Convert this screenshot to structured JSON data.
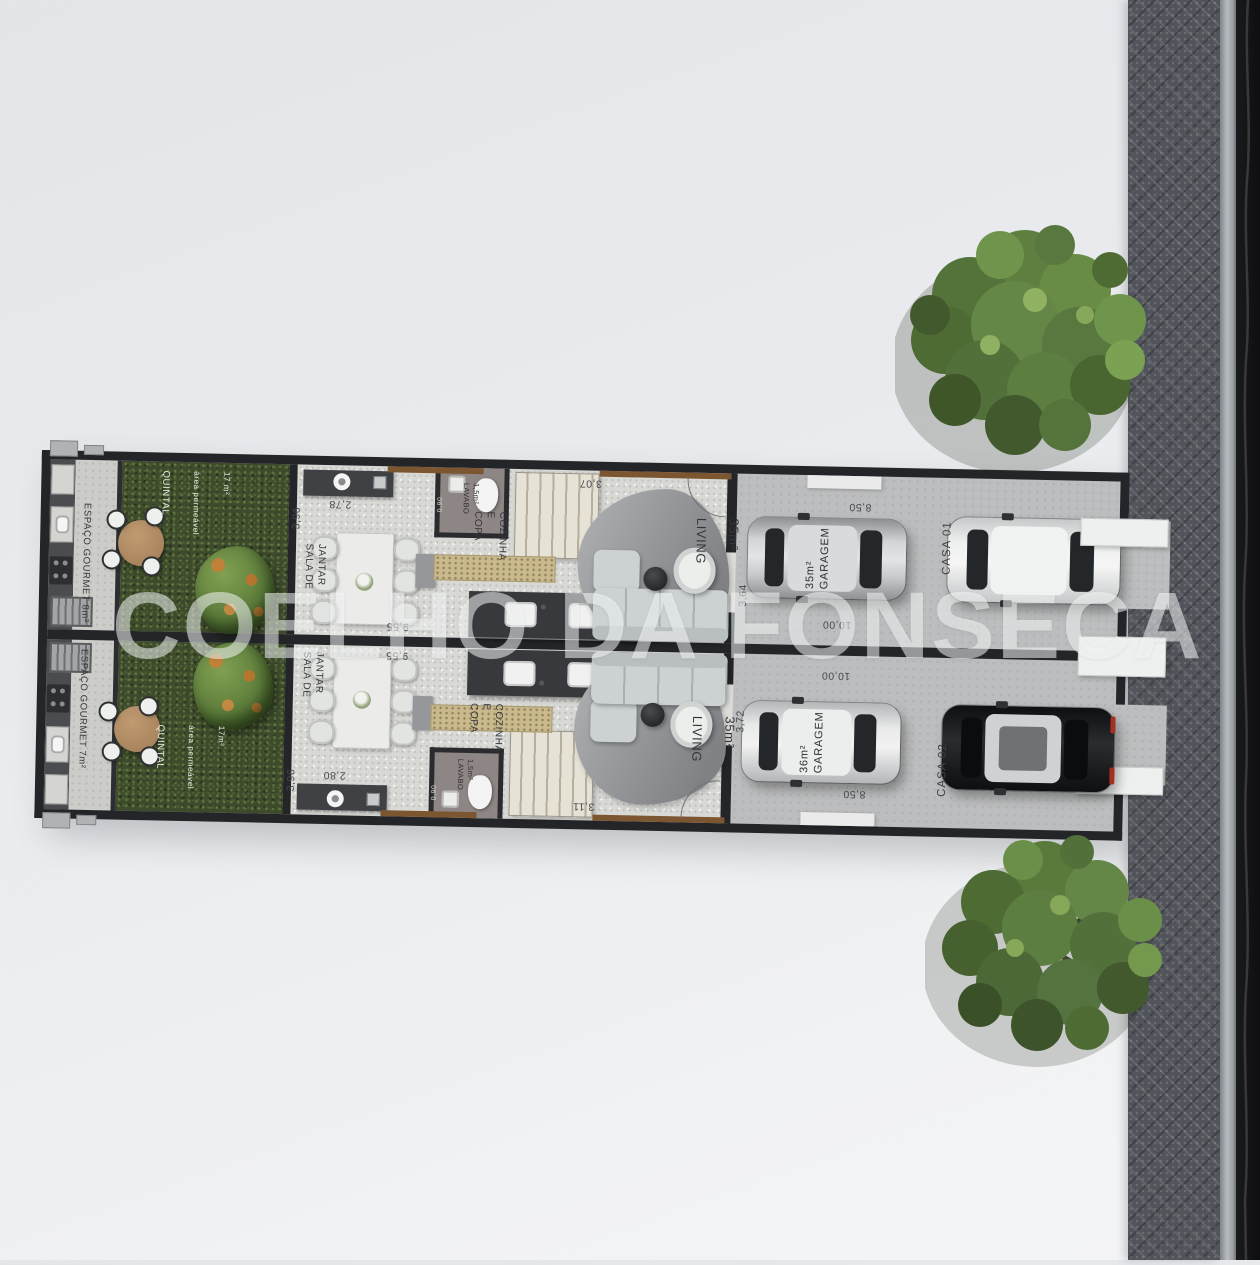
{
  "watermark": "COELHO DA FONSECA",
  "units": [
    {
      "casa": "CASA 01",
      "espaco_gourmet": "ESPAÇO GOURMET 8m²",
      "quintal": {
        "title": "QUINTAL",
        "subtitle": "área permeável",
        "area": "17 m²"
      },
      "sala_de_jantar": "SALA DE JANTAR",
      "copa_cozinha": "COPA\nE\nCOZINHA",
      "lavabo": {
        "label": "LAVABO",
        "area": "1,5m²"
      },
      "living": {
        "label": "LIVING",
        "area": "35m²"
      },
      "garagem": {
        "label": "GARAGEM",
        "area": "35m²"
      },
      "dims": {
        "quintal_width": "3,96",
        "aparador": "2,78",
        "cozinha": "9,55",
        "hall": "3,07",
        "lavabo": "0,90",
        "entrada": "3,64",
        "garagem_larg": "8,50",
        "garagem_comp": "10,00"
      }
    },
    {
      "casa": "CASA 02",
      "espaco_gourmet": "ESPAÇO GOURMET 7m²",
      "quintal": {
        "title": "QUINTAL",
        "subtitle": "área permeável",
        "area": "17m²"
      },
      "sala_de_jantar": "SALA DE JANTAR",
      "copa_cozinha": "COPA\nE\nCOZINHA",
      "lavabo": {
        "label": "LAVABO",
        "area": "1,5m²"
      },
      "living": {
        "label": "LIVING",
        "area": "35m²"
      },
      "garagem": {
        "label": "GARAGEM",
        "area": "36m²"
      },
      "dims": {
        "quintal_width": "3,96",
        "aparador": "2,80",
        "cozinha": "9,55",
        "hall": "3,11",
        "lavabo": "0,90",
        "entrada": "3,72",
        "garagem_larg": "8,50",
        "garagem_comp": "10,00"
      }
    }
  ]
}
